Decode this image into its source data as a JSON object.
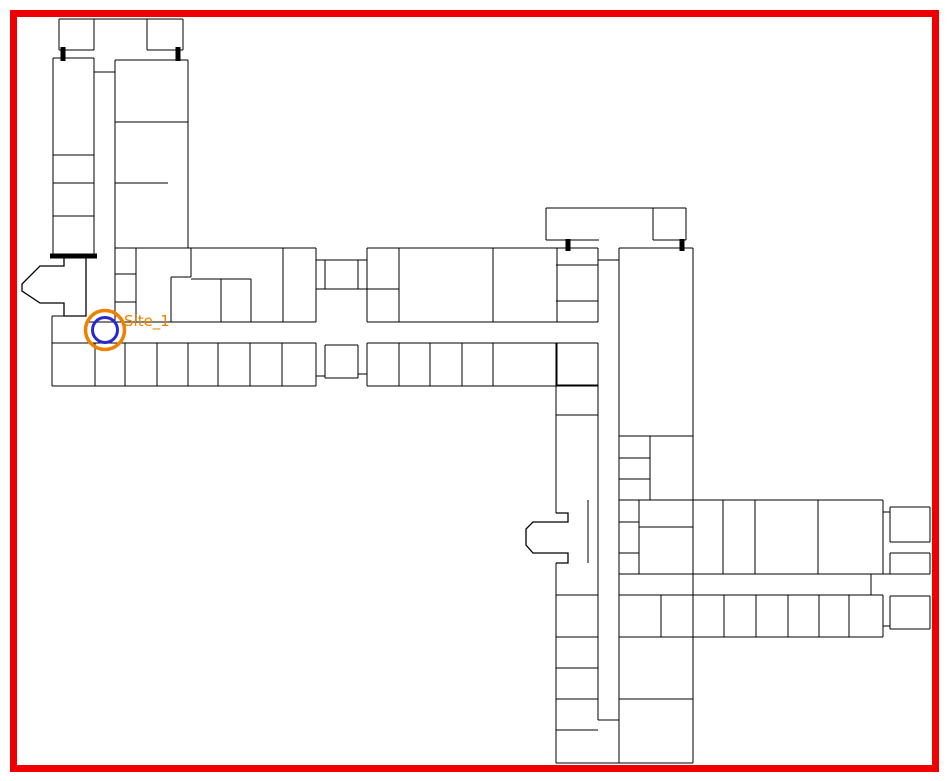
{
  "canvas": {
    "width": 949,
    "height": 781,
    "background": "#ffffff"
  },
  "selection_border": {
    "x": 13.5,
    "y": 13.5,
    "width": 922,
    "height": 755,
    "color": "#ee0000",
    "thickness": 7
  },
  "site_marker": {
    "label": "Site_1",
    "label_color": "#ee8100",
    "label_font_size": 15,
    "label_x": 124,
    "label_y": 326,
    "cx": 105,
    "cy": 330,
    "outer_radius": 19.5,
    "outer_stroke_width": 3.5,
    "outer_color": "#ee8100",
    "inner_radius": 12.5,
    "inner_stroke_width": 3,
    "inner_color": "#2929d2"
  },
  "floorplan": {
    "wall_color": "#000000",
    "wall_thickness": 1.3,
    "door_color": "#000000",
    "door_thickness": 5,
    "walls": [
      [
        59,
        19,
        183,
        19
      ],
      [
        59,
        19,
        59,
        50
      ],
      [
        59,
        50,
        94,
        50
      ],
      [
        94,
        19,
        94,
        50
      ],
      [
        147,
        19,
        147,
        50
      ],
      [
        147,
        50,
        183,
        50
      ],
      [
        183,
        19,
        183,
        50
      ],
      [
        53,
        58,
        94,
        58
      ],
      [
        53,
        58,
        53,
        256
      ],
      [
        94,
        58,
        94,
        256
      ],
      [
        53,
        155,
        94,
        155
      ],
      [
        53,
        183,
        94,
        183
      ],
      [
        53,
        216,
        94,
        216
      ],
      [
        115,
        60,
        188,
        60
      ],
      [
        115,
        60,
        115,
        248
      ],
      [
        188,
        60,
        188,
        248
      ],
      [
        94,
        72,
        115,
        72
      ],
      [
        115,
        122,
        188,
        122
      ],
      [
        115,
        183,
        168,
        183
      ],
      [
        115,
        248,
        316,
        248
      ],
      [
        115,
        248,
        115,
        322
      ],
      [
        316,
        248,
        316,
        322
      ],
      [
        86,
        322,
        316,
        322
      ],
      [
        136,
        248,
        136,
        322
      ],
      [
        115,
        274,
        136,
        274
      ],
      [
        115,
        302,
        136,
        302
      ],
      [
        191,
        248,
        191,
        277
      ],
      [
        171,
        277,
        191,
        277
      ],
      [
        171,
        277,
        171,
        322
      ],
      [
        191,
        279,
        251,
        279
      ],
      [
        221,
        279,
        221,
        322
      ],
      [
        251,
        279,
        251,
        322
      ],
      [
        283,
        248,
        283,
        322
      ],
      [
        52,
        316,
        64,
        316
      ],
      [
        52,
        316,
        52,
        386
      ],
      [
        52,
        343,
        316,
        343
      ],
      [
        52,
        386,
        316,
        386
      ],
      [
        316,
        343,
        316,
        386
      ],
      [
        95,
        343,
        95,
        386
      ],
      [
        125,
        343,
        125,
        386
      ],
      [
        157,
        343,
        157,
        386
      ],
      [
        188,
        343,
        188,
        386
      ],
      [
        218,
        343,
        218,
        386
      ],
      [
        250,
        343,
        250,
        386
      ],
      [
        282,
        343,
        282,
        386
      ],
      [
        325,
        260,
        358,
        260
      ],
      [
        325,
        289,
        358,
        289
      ],
      [
        325,
        260,
        325,
        289
      ],
      [
        358,
        260,
        358,
        289
      ],
      [
        316,
        260,
        325,
        260
      ],
      [
        358,
        260,
        367,
        260
      ],
      [
        316,
        289,
        325,
        289
      ],
      [
        358,
        289,
        367,
        289
      ],
      [
        325,
        345,
        358,
        345
      ],
      [
        325,
        378,
        358,
        378
      ],
      [
        325,
        345,
        325,
        378
      ],
      [
        358,
        345,
        358,
        378
      ],
      [
        316,
        376,
        325,
        376
      ],
      [
        358,
        374,
        367,
        374
      ],
      [
        367,
        248,
        598,
        248
      ],
      [
        367,
        248,
        367,
        322
      ],
      [
        367,
        322,
        598,
        322
      ],
      [
        399,
        248,
        399,
        322
      ],
      [
        367,
        289,
        399,
        289
      ],
      [
        493,
        248,
        493,
        322
      ],
      [
        557,
        248,
        557,
        322
      ],
      [
        556,
        265,
        598,
        265
      ],
      [
        556,
        301,
        598,
        301
      ],
      [
        598,
        248,
        598,
        322
      ],
      [
        367,
        343,
        598,
        343
      ],
      [
        367,
        386,
        598,
        386
      ],
      [
        367,
        343,
        367,
        386
      ],
      [
        399,
        343,
        399,
        386
      ],
      [
        430,
        343,
        430,
        386
      ],
      [
        462,
        343,
        462,
        386
      ],
      [
        493,
        343,
        493,
        386
      ],
      [
        557,
        343,
        557,
        386
      ],
      [
        598,
        260,
        619,
        260
      ],
      [
        546,
        208,
        686,
        208
      ],
      [
        546,
        208,
        546,
        240
      ],
      [
        546,
        240,
        599,
        240
      ],
      [
        653,
        208,
        653,
        240
      ],
      [
        653,
        240,
        686,
        240
      ],
      [
        686,
        208,
        686,
        240
      ],
      [
        556,
        343,
        556,
        513
      ],
      [
        556,
        385,
        598,
        385
      ],
      [
        556,
        415,
        598,
        415
      ],
      [
        588,
        500,
        588,
        563
      ],
      [
        556,
        563,
        556,
        763
      ],
      [
        598,
        343,
        598,
        720
      ],
      [
        556,
        595,
        598,
        595
      ],
      [
        556,
        637,
        598,
        637
      ],
      [
        556,
        668,
        598,
        668
      ],
      [
        556,
        699,
        598,
        699
      ],
      [
        556,
        730,
        598,
        730
      ],
      [
        598,
        720,
        619,
        720
      ],
      [
        556,
        763,
        693,
        763
      ],
      [
        619,
        248,
        693,
        248
      ],
      [
        619,
        248,
        619,
        763
      ],
      [
        693,
        248,
        693,
        763
      ],
      [
        619,
        436,
        693,
        436
      ],
      [
        650,
        436,
        650,
        500
      ],
      [
        619,
        458,
        650,
        458
      ],
      [
        619,
        479,
        650,
        479
      ],
      [
        619,
        500,
        883,
        500
      ],
      [
        639,
        500,
        639,
        574
      ],
      [
        619,
        522,
        639,
        522
      ],
      [
        619,
        553,
        639,
        553
      ],
      [
        639,
        527,
        693,
        527
      ],
      [
        723,
        500,
        723,
        574
      ],
      [
        755,
        500,
        755,
        574
      ],
      [
        818,
        500,
        818,
        574
      ],
      [
        883,
        500,
        883,
        574
      ],
      [
        619,
        574,
        883,
        574
      ],
      [
        619,
        595,
        883,
        595
      ],
      [
        871,
        574,
        871,
        595
      ],
      [
        619,
        637,
        883,
        637
      ],
      [
        883,
        595,
        883,
        637
      ],
      [
        661,
        595,
        661,
        637
      ],
      [
        724,
        595,
        724,
        637
      ],
      [
        756,
        595,
        756,
        637
      ],
      [
        788,
        595,
        788,
        637
      ],
      [
        819,
        595,
        819,
        637
      ],
      [
        849,
        595,
        849,
        637
      ],
      [
        619,
        699,
        693,
        699
      ],
      [
        890,
        507,
        930,
        507
      ],
      [
        890,
        542,
        930,
        542
      ],
      [
        890,
        507,
        890,
        542
      ],
      [
        930,
        507,
        930,
        542
      ],
      [
        890,
        553,
        930,
        553
      ],
      [
        890,
        574,
        930,
        574
      ],
      [
        890,
        553,
        890,
        574
      ],
      [
        930,
        553,
        930,
        574
      ],
      [
        890,
        596,
        930,
        596
      ],
      [
        890,
        629,
        930,
        629
      ],
      [
        890,
        596,
        890,
        629
      ],
      [
        930,
        596,
        930,
        629
      ],
      [
        883,
        512,
        890,
        512
      ],
      [
        883,
        574,
        890,
        574
      ],
      [
        883,
        626,
        890,
        626
      ]
    ],
    "doors": [
      [
        63,
        47,
        63,
        61
      ],
      [
        178,
        47,
        178,
        61
      ],
      [
        568,
        239,
        568,
        251
      ],
      [
        682,
        239,
        682,
        251
      ],
      [
        50,
        256,
        97,
        256
      ]
    ],
    "bays": [
      [
        [
          64,
          258
        ],
        [
          64,
          266
        ],
        [
          40,
          266
        ],
        [
          22,
          284
        ],
        [
          22,
          291
        ],
        [
          40,
          303
        ],
        [
          64,
          303
        ],
        [
          64,
          316
        ],
        [
          86,
          316
        ],
        [
          86,
          257
        ]
      ],
      [
        [
          556,
          513
        ],
        [
          568,
          513
        ],
        [
          568,
          522
        ],
        [
          533,
          522
        ],
        [
          526,
          529
        ],
        [
          526,
          545
        ],
        [
          533,
          553
        ],
        [
          568,
          553
        ],
        [
          568,
          563
        ],
        [
          556,
          563
        ]
      ]
    ]
  }
}
